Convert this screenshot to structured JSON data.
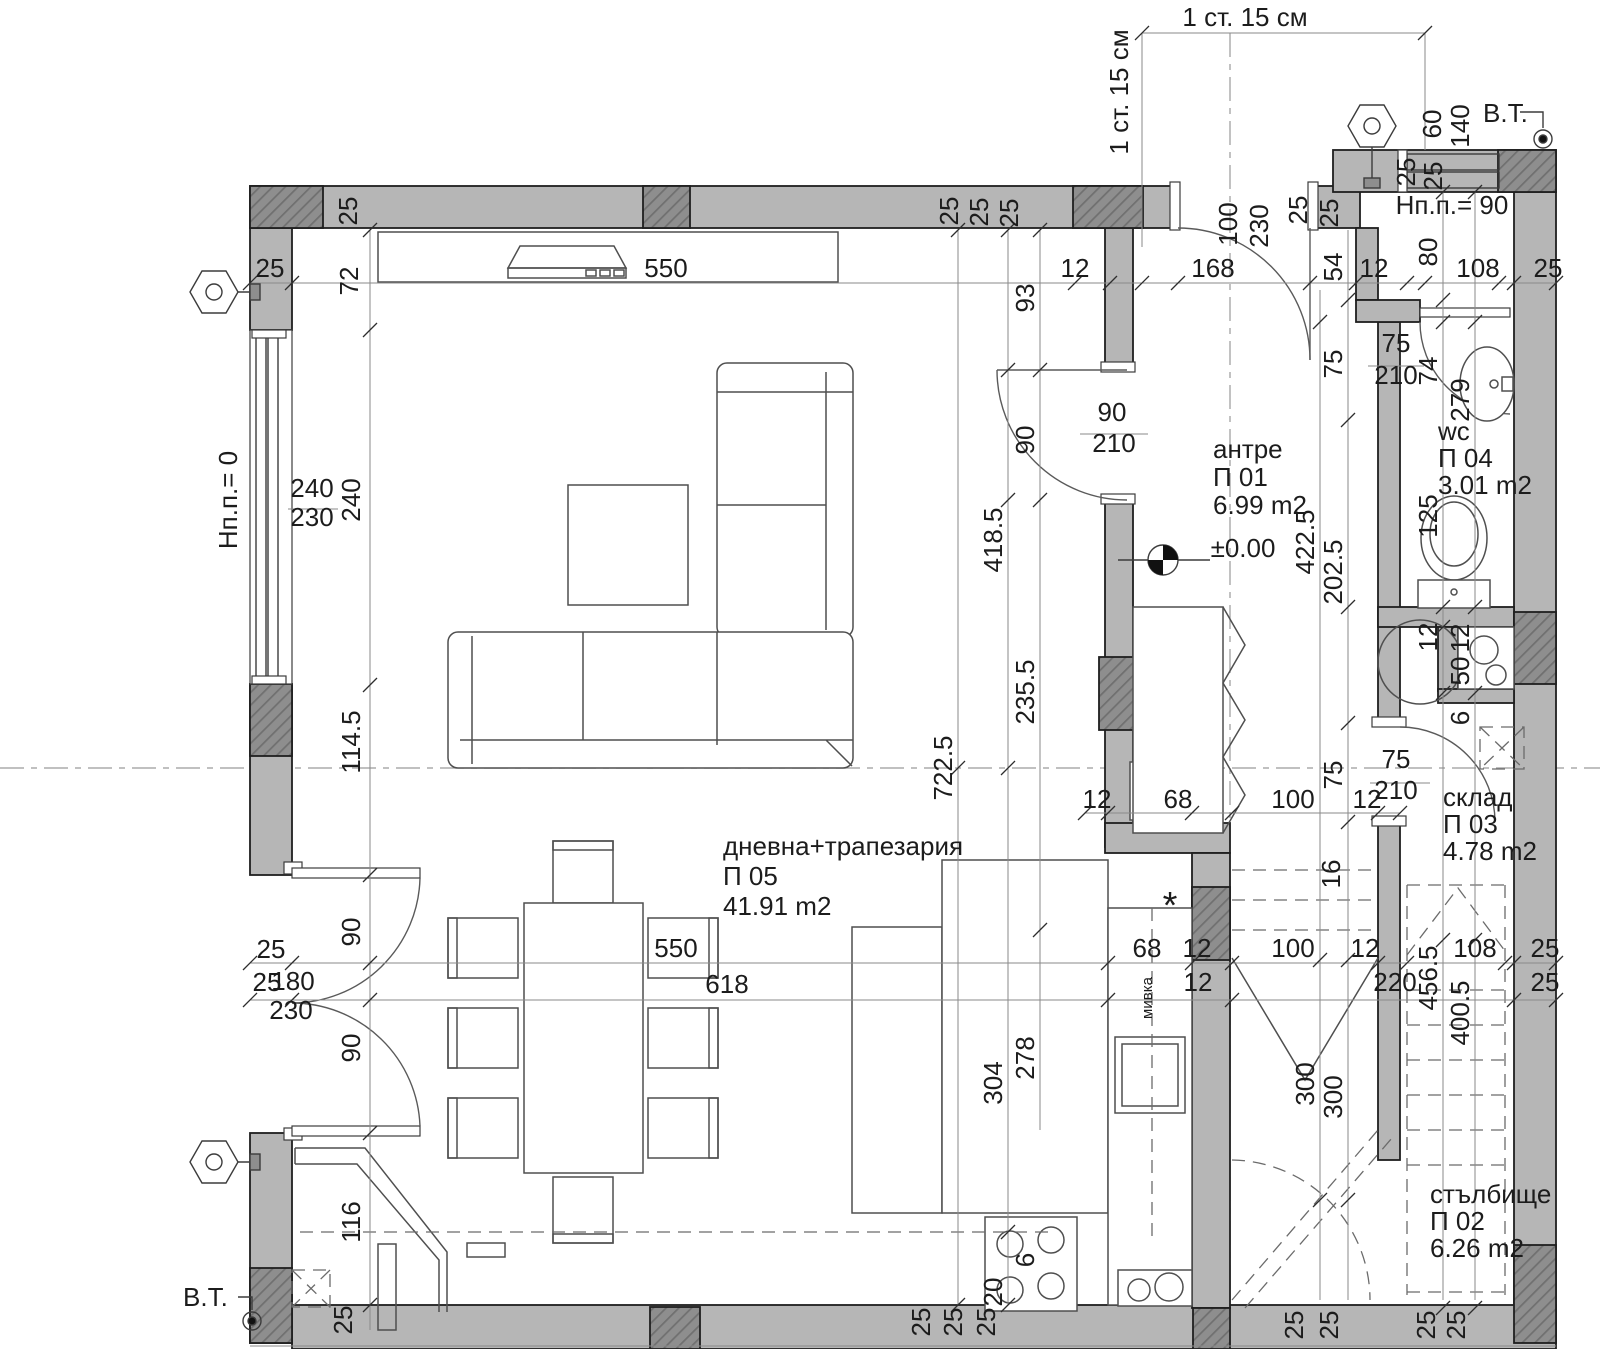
{
  "drawing": {
    "background": "#ffffff",
    "wall_fill": "#b6b6b6",
    "column_fill": "#8e8e8e",
    "line_color": "#1f1f1f",
    "dim_color": "#1c1c1c"
  },
  "rooms": [
    {
      "name": "антре",
      "code": "П 01",
      "area": "6.99 m2"
    },
    {
      "name": "стълбище",
      "code": "П 02",
      "area": "6.26 m2"
    },
    {
      "name": "склад",
      "code": "П 03",
      "area": "4.78 m2"
    },
    {
      "name": "wc",
      "code": "П 04",
      "area": "3.01 m2"
    },
    {
      "name": "дневна+трапезария",
      "code": "П 05",
      "area": "41.91 m2"
    }
  ],
  "levels": {
    "floor": "±0.00",
    "terrace_sill": "Нп.п.= 0",
    "bath_sill": "Нп.п.= 90"
  },
  "notes": {
    "step_note": "1 ст. 15 см",
    "vt": "В.Т.",
    "kitchen_sink": "мивка"
  },
  "annotations": [
    {
      "t": "1 ст. 15 см",
      "x": 1245,
      "y": 26
    },
    {
      "t": "1 ст. 15 см",
      "x": 1128,
      "y": 92,
      "r": 1
    },
    {
      "t": "В.Т.",
      "x": 1483,
      "y": 122,
      "a": "start"
    },
    {
      "t": "В.Т.",
      "x": 183,
      "y": 1306,
      "a": "start"
    },
    {
      "t": "Нп.п.= 0",
      "x": 237,
      "y": 500,
      "r": 1
    },
    {
      "t": "Нп.п.= 90",
      "x": 1452,
      "y": 214
    },
    {
      "t": "±0.00",
      "x": 1243,
      "y": 557
    },
    {
      "t": "мивка",
      "x": 1152,
      "y": 998,
      "r": 1,
      "s": 1
    },
    {
      "t": "*",
      "x": 1170,
      "y": 918,
      "s": 2
    }
  ],
  "dims": [
    {
      "t": "25",
      "x": 270,
      "y": 277
    },
    {
      "t": "550",
      "x": 666,
      "y": 277
    },
    {
      "t": "12",
      "x": 1075,
      "y": 277
    },
    {
      "t": "168",
      "x": 1213,
      "y": 277
    },
    {
      "t": "108",
      "x": 1478,
      "y": 277
    },
    {
      "t": "25",
      "x": 1548,
      "y": 277
    },
    {
      "t": "12",
      "x": 1374,
      "y": 277
    },
    {
      "t": "25",
      "x": 357,
      "y": 211,
      "r": 1
    },
    {
      "t": "25",
      "x": 958,
      "y": 211,
      "r": 1
    },
    {
      "t": "25",
      "x": 988,
      "y": 212,
      "r": 1
    },
    {
      "t": "25",
      "x": 1018,
      "y": 213,
      "r": 1
    },
    {
      "t": "100",
      "x": 1237,
      "y": 224,
      "r": 1
    },
    {
      "t": "230",
      "x": 1268,
      "y": 226,
      "r": 1
    },
    {
      "t": "25",
      "x": 1307,
      "y": 210,
      "r": 1
    },
    {
      "t": "25",
      "x": 1338,
      "y": 213,
      "r": 1
    },
    {
      "t": "54",
      "x": 1342,
      "y": 267,
      "r": 1
    },
    {
      "t": "72",
      "x": 358,
      "y": 281,
      "r": 1
    },
    {
      "t": "93",
      "x": 1034,
      "y": 298,
      "r": 1
    },
    {
      "t": "80",
      "x": 1437,
      "y": 252,
      "r": 1
    },
    {
      "t": "60",
      "x": 1441,
      "y": 124,
      "r": 1
    },
    {
      "t": "140",
      "x": 1469,
      "y": 126,
      "r": 1
    },
    {
      "t": "25",
      "x": 1415,
      "y": 172,
      "r": 1
    },
    {
      "t": "25",
      "x": 1442,
      "y": 176,
      "r": 1
    },
    {
      "t": "240",
      "x": 360,
      "y": 500,
      "r": 1
    },
    {
      "t": "114.5",
      "x": 360,
      "y": 742,
      "r": 1
    },
    {
      "t": "90",
      "x": 360,
      "y": 932,
      "r": 1
    },
    {
      "t": "90",
      "x": 360,
      "y": 1048,
      "r": 1
    },
    {
      "t": "116",
      "x": 360,
      "y": 1222,
      "r": 1
    },
    {
      "t": "25",
      "x": 352,
      "y": 1320,
      "r": 1
    },
    {
      "t": "240",
      "x": 312,
      "y": 497
    },
    {
      "t": "230",
      "x": 312,
      "y": 526
    },
    {
      "t": "25",
      "x": 271,
      "y": 958
    },
    {
      "t": "25",
      "x": 267,
      "y": 991
    },
    {
      "t": "180",
      "x": 293,
      "y": 990
    },
    {
      "t": "230",
      "x": 291,
      "y": 1019
    },
    {
      "t": "722.5",
      "x": 952,
      "y": 768,
      "r": 1
    },
    {
      "t": "418.5",
      "x": 1002,
      "y": 540,
      "r": 1
    },
    {
      "t": "235.5",
      "x": 1034,
      "y": 692,
      "r": 1
    },
    {
      "t": "90",
      "x": 1034,
      "y": 440,
      "r": 1
    },
    {
      "t": "304",
      "x": 1002,
      "y": 1083,
      "r": 1
    },
    {
      "t": "278",
      "x": 1034,
      "y": 1058,
      "r": 1
    },
    {
      "t": "6",
      "x": 1034,
      "y": 1260,
      "r": 1
    },
    {
      "t": "20",
      "x": 1002,
      "y": 1292,
      "r": 1
    },
    {
      "t": "90",
      "x": 1112,
      "y": 421
    },
    {
      "t": "210",
      "x": 1114,
      "y": 452
    },
    {
      "t": "75",
      "x": 1396,
      "y": 352
    },
    {
      "t": "210",
      "x": 1396,
      "y": 384
    },
    {
      "t": "75",
      "x": 1396,
      "y": 768
    },
    {
      "t": "210",
      "x": 1396,
      "y": 799
    },
    {
      "t": "422.5",
      "x": 1314,
      "y": 542,
      "r": 1
    },
    {
      "t": "202.5",
      "x": 1342,
      "y": 572,
      "r": 1
    },
    {
      "t": "75",
      "x": 1342,
      "y": 364,
      "r": 1
    },
    {
      "t": "75",
      "x": 1342,
      "y": 775,
      "r": 1
    },
    {
      "t": "74",
      "x": 1437,
      "y": 371,
      "r": 1
    },
    {
      "t": "279",
      "x": 1469,
      "y": 400,
      "r": 1
    },
    {
      "t": "125",
      "x": 1437,
      "y": 516,
      "r": 1
    },
    {
      "t": "12",
      "x": 1437,
      "y": 637,
      "r": 1
    },
    {
      "t": "12",
      "x": 1469,
      "y": 638,
      "r": 1
    },
    {
      "t": "50",
      "x": 1469,
      "y": 671,
      "r": 1
    },
    {
      "t": "6",
      "x": 1469,
      "y": 718,
      "r": 1
    },
    {
      "t": "456.5",
      "x": 1437,
      "y": 978,
      "r": 1
    },
    {
      "t": "400.5",
      "x": 1469,
      "y": 1013,
      "r": 1
    },
    {
      "t": "300",
      "x": 1314,
      "y": 1084,
      "r": 1
    },
    {
      "t": "300",
      "x": 1342,
      "y": 1097,
      "r": 1
    },
    {
      "t": "16",
      "x": 1340,
      "y": 874,
      "r": 1
    },
    {
      "t": "12",
      "x": 1097,
      "y": 808
    },
    {
      "t": "68",
      "x": 1178,
      "y": 808
    },
    {
      "t": "100",
      "x": 1293,
      "y": 808
    },
    {
      "t": "12",
      "x": 1367,
      "y": 808
    },
    {
      "t": "550",
      "x": 676,
      "y": 957
    },
    {
      "t": "68",
      "x": 1147,
      "y": 957
    },
    {
      "t": "12",
      "x": 1197,
      "y": 957
    },
    {
      "t": "100",
      "x": 1293,
      "y": 957
    },
    {
      "t": "12",
      "x": 1365,
      "y": 957
    },
    {
      "t": "108",
      "x": 1475,
      "y": 957
    },
    {
      "t": "25",
      "x": 1545,
      "y": 957
    },
    {
      "t": "618",
      "x": 727,
      "y": 993
    },
    {
      "t": "12",
      "x": 1198,
      "y": 991
    },
    {
      "t": "220",
      "x": 1395,
      "y": 991
    },
    {
      "t": "25",
      "x": 1545,
      "y": 991
    },
    {
      "t": "25",
      "x": 930,
      "y": 1322,
      "r": 1
    },
    {
      "t": "25",
      "x": 962,
      "y": 1322,
      "r": 1
    },
    {
      "t": "25",
      "x": 995,
      "y": 1322,
      "r": 1
    },
    {
      "t": "25",
      "x": 1303,
      "y": 1325,
      "r": 1
    },
    {
      "t": "25",
      "x": 1338,
      "y": 1325,
      "r": 1
    },
    {
      "t": "25",
      "x": 1435,
      "y": 1325,
      "r": 1
    },
    {
      "t": "25",
      "x": 1465,
      "y": 1325,
      "r": 1
    }
  ]
}
